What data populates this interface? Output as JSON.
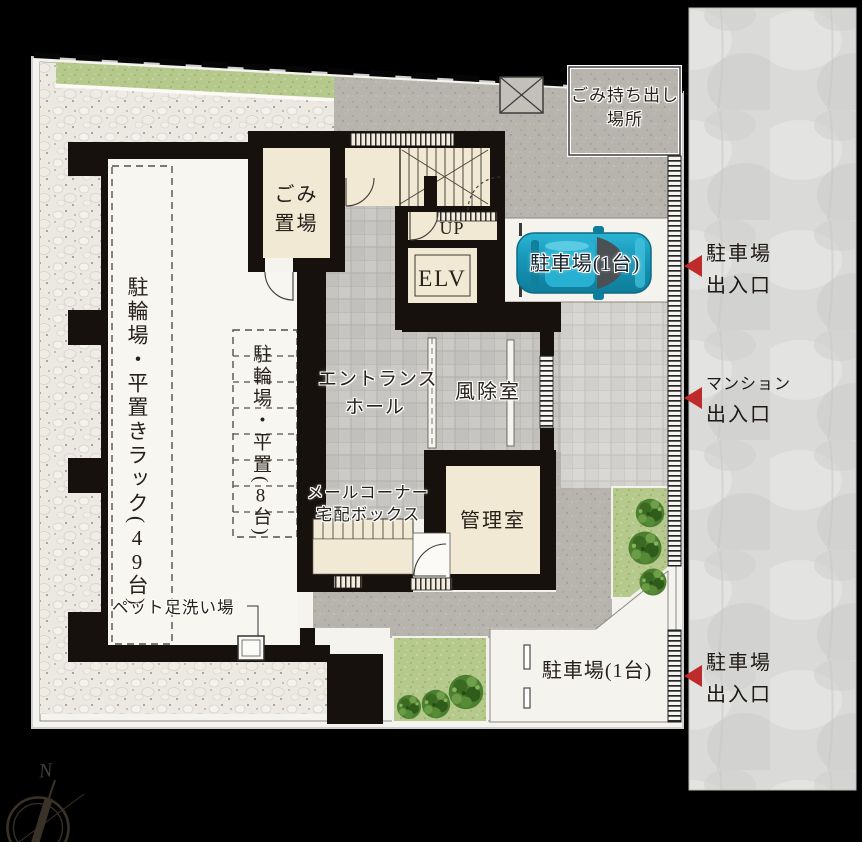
{
  "rooms": {
    "bicycle_rack": {
      "pre": "駐輪場・平置きラック(",
      "num": "49",
      "suf": "台)"
    },
    "bicycle_flat": {
      "pre": "駐輪場・平置(",
      "num": "8",
      "suf": "台)"
    },
    "garbage_line1": "ごみ",
    "garbage_line2": "置場",
    "stairs_label": "UP",
    "elevator_label": "ELV",
    "hall_line1": "エントランス",
    "hall_line2": "ホール",
    "windbreak_label": "風除室",
    "mail_line1": "メールコーナー",
    "mail_line2": "宅配ボックス",
    "manager_label": "管理室",
    "pet_wash_label": "ペット足洗い場",
    "garbage_out_line1": "ごみ持ち出し",
    "garbage_out_line2": "場所",
    "parking_top_label": "駐車場(1台)",
    "parking_bottom_label": "駐車場(1台)"
  },
  "street": {
    "gates": [
      {
        "line1": "駐車場",
        "line2": "出入口"
      },
      {
        "line1": "マンション",
        "line2": "出入口"
      },
      {
        "line1": "駐車場",
        "line2": "出入口"
      }
    ]
  },
  "compass": {
    "north": "N"
  },
  "colors": {
    "background": "#000000",
    "gate_arrow": "#bf2a2a",
    "wall": "#17110d",
    "room_cream": "#f2e9d5",
    "grass": "#b7ca8e",
    "car_body": "#1ba4c6",
    "street_surface": "#dadad8"
  }
}
